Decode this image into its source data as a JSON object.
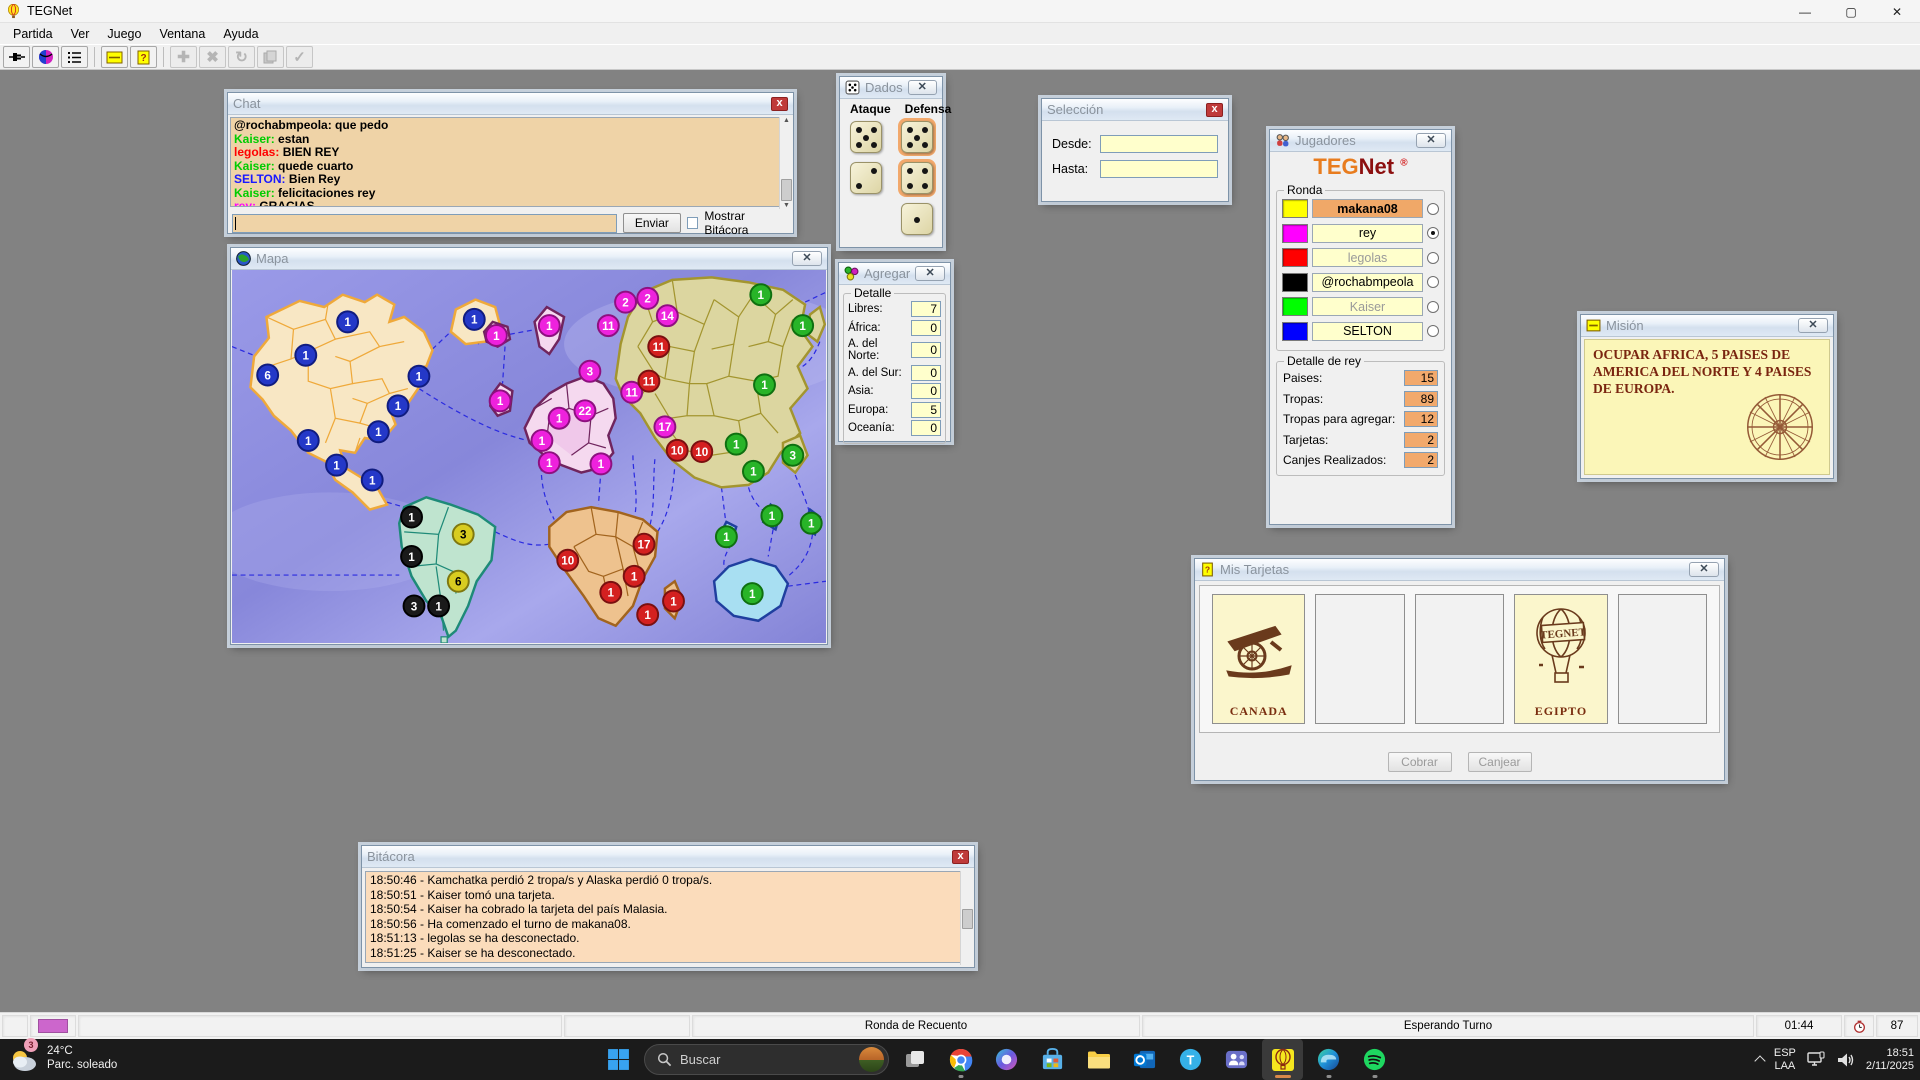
{
  "app": {
    "title": "TEGNet"
  },
  "menu": {
    "items": [
      "Partida",
      "Ver",
      "Juego",
      "Ventana",
      "Ayuda"
    ]
  },
  "chat": {
    "title": "Chat",
    "messages": [
      {
        "user": "@rochabmpeola",
        "color": "#000000",
        "text": "que pedo"
      },
      {
        "user": "Kaiser",
        "color": "#00cc00",
        "text": "estan"
      },
      {
        "user": "legolas",
        "color": "#ff0000",
        "text": "BIEN REY"
      },
      {
        "user": "Kaiser",
        "color": "#00cc00",
        "text": "quede cuarto"
      },
      {
        "user": "SELTON",
        "color": "#1818ff",
        "text": "Bien Rey"
      },
      {
        "user": "Kaiser",
        "color": "#00cc00",
        "text": "felicitaciones rey"
      },
      {
        "user": "rey",
        "color": "#ff00ff",
        "text": "GRACIAS"
      }
    ],
    "input_value": "",
    "send_label": "Enviar",
    "checkbox_label": "Mostrar Bitácora",
    "checkbox_checked": false
  },
  "dados": {
    "title": "Dados",
    "attack_label": "Ataque",
    "defense_label": "Defensa",
    "attack": [
      5,
      2
    ],
    "defense": [
      5,
      4,
      1
    ],
    "defense_highlighted": [
      0,
      1
    ]
  },
  "mapa": {
    "title": "Mapa",
    "owner_colors": {
      "makana08": {
        "fill": "#d8cc20",
        "stroke": "#80780f",
        "text": "#000000"
      },
      "rey": {
        "fill": "#ee22dd",
        "stroke": "#8e1080",
        "text": "#ffffff"
      },
      "legolas": {
        "fill": "#d42020",
        "stroke": "#7a1010",
        "text": "#ffffff"
      },
      "@rochabmpeola": {
        "fill": "#1a1a1a",
        "stroke": "#000000",
        "text": "#ffffff"
      },
      "Kaiser": {
        "fill": "#28b428",
        "stroke": "#0f7010",
        "text": "#ffffff"
      },
      "SELTON": {
        "fill": "#2438c8",
        "stroke": "#101c80",
        "text": "#ffffff"
      }
    },
    "armies": [
      {
        "owner": "SELTON",
        "x": 94,
        "y": 42,
        "n": 1
      },
      {
        "owner": "SELTON",
        "x": 60,
        "y": 69,
        "n": 1
      },
      {
        "owner": "SELTON",
        "x": 29,
        "y": 85,
        "n": 6
      },
      {
        "owner": "SELTON",
        "x": 152,
        "y": 86,
        "n": 1
      },
      {
        "owner": "SELTON",
        "x": 135,
        "y": 110,
        "n": 1
      },
      {
        "owner": "SELTON",
        "x": 119,
        "y": 131,
        "n": 1
      },
      {
        "owner": "SELTON",
        "x": 62,
        "y": 138,
        "n": 1
      },
      {
        "owner": "SELTON",
        "x": 85,
        "y": 158,
        "n": 1
      },
      {
        "owner": "SELTON",
        "x": 197,
        "y": 40,
        "n": 1
      },
      {
        "owner": "SELTON",
        "x": 114,
        "y": 170,
        "n": 1
      },
      {
        "owner": "@rochabmpeola",
        "x": 146,
        "y": 200,
        "n": 1
      },
      {
        "owner": "@rochabmpeola",
        "x": 146,
        "y": 232,
        "n": 1
      },
      {
        "owner": "@rochabmpeola",
        "x": 148,
        "y": 272,
        "n": 3
      },
      {
        "owner": "@rochabmpeola",
        "x": 168,
        "y": 272,
        "n": 1
      },
      {
        "owner": "makana08",
        "x": 188,
        "y": 214,
        "n": 3
      },
      {
        "owner": "makana08",
        "x": 184,
        "y": 252,
        "n": 6
      },
      {
        "owner": "rey",
        "x": 215,
        "y": 53,
        "n": 1
      },
      {
        "owner": "rey",
        "x": 258,
        "y": 45,
        "n": 1
      },
      {
        "owner": "rey",
        "x": 218,
        "y": 106,
        "n": 1
      },
      {
        "owner": "rey",
        "x": 291,
        "y": 82,
        "n": 3
      },
      {
        "owner": "rey",
        "x": 266,
        "y": 120,
        "n": 1
      },
      {
        "owner": "rey",
        "x": 287,
        "y": 114,
        "n": 22
      },
      {
        "owner": "rey",
        "x": 252,
        "y": 138,
        "n": 1
      },
      {
        "owner": "rey",
        "x": 258,
        "y": 156,
        "n": 1
      },
      {
        "owner": "rey",
        "x": 300,
        "y": 157,
        "n": 1
      },
      {
        "owner": "rey",
        "x": 320,
        "y": 26,
        "n": 2
      },
      {
        "owner": "rey",
        "x": 338,
        "y": 23,
        "n": 2
      },
      {
        "owner": "rey",
        "x": 354,
        "y": 37,
        "n": 14
      },
      {
        "owner": "rey",
        "x": 306,
        "y": 45,
        "n": 11
      },
      {
        "owner": "rey",
        "x": 325,
        "y": 99,
        "n": 11
      },
      {
        "owner": "rey",
        "x": 352,
        "y": 127,
        "n": 17
      },
      {
        "owner": "legolas",
        "x": 347,
        "y": 62,
        "n": 11
      },
      {
        "owner": "legolas",
        "x": 339,
        "y": 90,
        "n": 11
      },
      {
        "owner": "legolas",
        "x": 362,
        "y": 146,
        "n": 10
      },
      {
        "owner": "legolas",
        "x": 382,
        "y": 147,
        "n": 10
      },
      {
        "owner": "legolas",
        "x": 335,
        "y": 222,
        "n": 17
      },
      {
        "owner": "legolas",
        "x": 273,
        "y": 235,
        "n": 10
      },
      {
        "owner": "legolas",
        "x": 327,
        "y": 248,
        "n": 1
      },
      {
        "owner": "legolas",
        "x": 308,
        "y": 261,
        "n": 1
      },
      {
        "owner": "legolas",
        "x": 338,
        "y": 279,
        "n": 1
      },
      {
        "owner": "legolas",
        "x": 359,
        "y": 268,
        "n": 1
      },
      {
        "owner": "Kaiser",
        "x": 430,
        "y": 20,
        "n": 1
      },
      {
        "owner": "Kaiser",
        "x": 464,
        "y": 45,
        "n": 1
      },
      {
        "owner": "Kaiser",
        "x": 433,
        "y": 93,
        "n": 1
      },
      {
        "owner": "Kaiser",
        "x": 410,
        "y": 141,
        "n": 1
      },
      {
        "owner": "Kaiser",
        "x": 456,
        "y": 150,
        "n": 3
      },
      {
        "owner": "Kaiser",
        "x": 424,
        "y": 163,
        "n": 1
      },
      {
        "owner": "Kaiser",
        "x": 402,
        "y": 216,
        "n": 1
      },
      {
        "owner": "Kaiser",
        "x": 439,
        "y": 199,
        "n": 1
      },
      {
        "owner": "Kaiser",
        "x": 471,
        "y": 205,
        "n": 1
      },
      {
        "owner": "Kaiser",
        "x": 423,
        "y": 262,
        "n": 1
      }
    ]
  },
  "seleccion": {
    "title": "Selección",
    "fields": [
      {
        "label": "Desde:",
        "value": ""
      },
      {
        "label": "Hasta:",
        "value": ""
      }
    ]
  },
  "agregar": {
    "title": "Agregar",
    "group": "Detalle",
    "rows": [
      {
        "label": "Libres:",
        "value": "7"
      },
      {
        "label": "África:",
        "value": "0"
      },
      {
        "label": "A. del Norte:",
        "value": "0"
      },
      {
        "label": "A. del Sur:",
        "value": "0"
      },
      {
        "label": "Asia:",
        "value": "0"
      },
      {
        "label": "Europa:",
        "value": "5"
      },
      {
        "label": "Oceanía:",
        "value": "0"
      }
    ]
  },
  "jugadores": {
    "title": "Jugadores",
    "logo": {
      "part1": "TEG",
      "part2": "Net",
      "reg": "®"
    },
    "group": "Ronda",
    "players": [
      {
        "name": "makana08",
        "color": "#ffff00",
        "row_bg": "#f0a868",
        "bold": true,
        "dimmed": false,
        "selected": false
      },
      {
        "name": "rey",
        "color": "#ff00ff",
        "row_bg": "#ffffcc",
        "bold": false,
        "dimmed": false,
        "selected": true
      },
      {
        "name": "legolas",
        "color": "#ff0000",
        "row_bg": "#ffffcc",
        "bold": false,
        "dimmed": true,
        "selected": false
      },
      {
        "name": "@rochabmpeola",
        "color": "#000000",
        "row_bg": "#ffffcc",
        "bold": false,
        "dimmed": false,
        "selected": false
      },
      {
        "name": "Kaiser",
        "color": "#00ff00",
        "row_bg": "#ffffcc",
        "bold": false,
        "dimmed": true,
        "selected": false
      },
      {
        "name": "SELTON",
        "color": "#0000ff",
        "row_bg": "#ffffcc",
        "bold": false,
        "dimmed": false,
        "selected": false
      }
    ],
    "detail_group": "Detalle de rey",
    "details": [
      {
        "label": "Paises:",
        "value": "15"
      },
      {
        "label": "Tropas:",
        "value": "89"
      },
      {
        "label": "Tropas para agregar:",
        "value": "12"
      },
      {
        "label": "Tarjetas:",
        "value": "2"
      },
      {
        "label": "Canjes Realizados:",
        "value": "2"
      }
    ]
  },
  "mision": {
    "title": "Misión",
    "text": "OCUPAR AFRICA, 5 PAISES DE AMERICA DEL NORTE Y 4 PAISES DE EUROPA."
  },
  "tarjetas": {
    "title": "Mis Tarjetas",
    "cards": [
      {
        "name": "CANADA",
        "art": "cannon"
      },
      {
        "name": "",
        "art": ""
      },
      {
        "name": "",
        "art": ""
      },
      {
        "name": "EGIPTO",
        "art": "balloon"
      },
      {
        "name": "",
        "art": ""
      }
    ],
    "balloon_label": "TEGNET",
    "buttons": [
      {
        "label": "Cobrar",
        "enabled": false
      },
      {
        "label": "Canjear",
        "enabled": false
      }
    ]
  },
  "bitacora": {
    "title": "Bitácora",
    "entries": [
      "18:50:46 - Kamchatka perdió 2 tropa/s y Alaska perdió 0 tropa/s.",
      "18:50:51 - Kaiser tomó una tarjeta.",
      "18:50:54 - Kaiser ha cobrado la tarjeta del país Malasia.",
      "18:50:56 - Ha comenzado el turno de makana08.",
      "18:51:13 - legolas se ha desconectado.",
      "18:51:25 - Kaiser se ha desconectado."
    ]
  },
  "statusbar": {
    "player_color": "#cc66cc",
    "round_label": "Ronda de Recuento",
    "state_label": "Esperando Turno",
    "timer": "01:44",
    "counter": "87"
  },
  "taskbar": {
    "weather": {
      "temp": "24°C",
      "condition": "Parc. soleado",
      "badge": "3"
    },
    "search_placeholder": "Buscar",
    "tray": {
      "lang_line1": "ESP",
      "lang_line2": "LAA",
      "time": "18:51",
      "date": "2/11/2025"
    }
  }
}
